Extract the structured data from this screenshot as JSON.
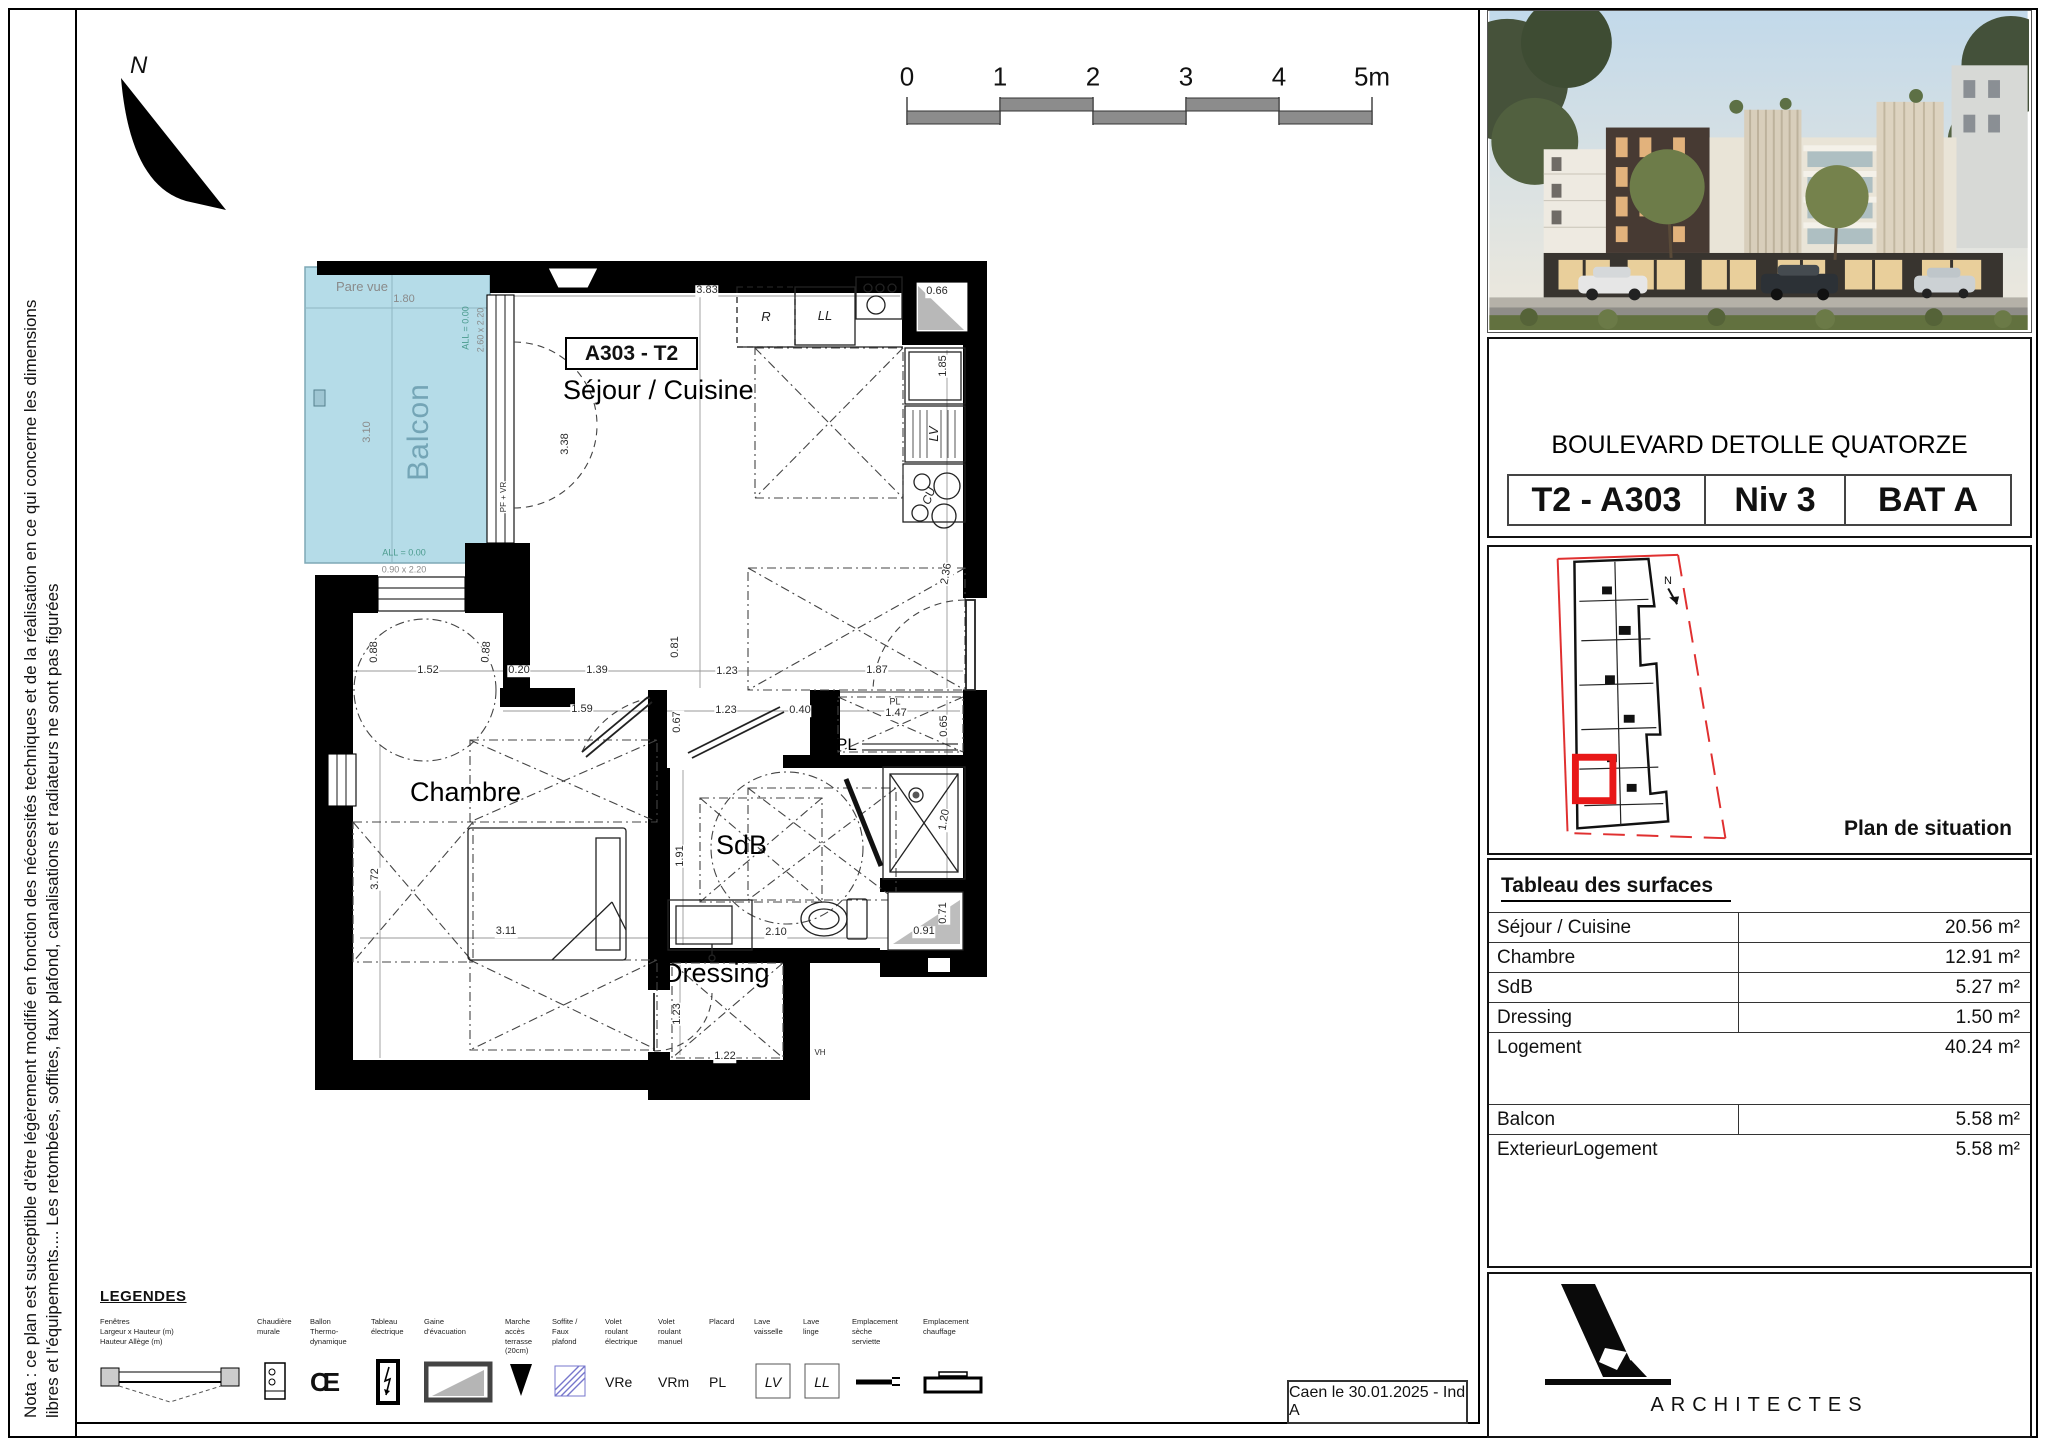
{
  "page": {
    "nota_line1": "Nota : ce plan est susceptible d'être légèrement modifié en fonction des nécessités techniques et de la réalisation en ce qui concerne les dimensions",
    "nota_line2": "libres et l'équipements.... Les retombées, soffites, faux plafond, canalisations et radiateurs ne sont pas figurées",
    "date_ref": "Caen le 30.01.2025 - Ind A",
    "north_label": "N"
  },
  "scalebar": {
    "labels": [
      "0",
      "1",
      "2",
      "3",
      "4",
      "5m"
    ]
  },
  "plan": {
    "unit_label": "A303 - T2",
    "rooms": {
      "sejour": "Séjour / Cuisine",
      "chambre": "Chambre",
      "sdb": "SdB",
      "dressing": "Dressing",
      "balcon": "Balcon",
      "placard": "PL"
    },
    "dimensions": [
      {
        "t": "Pare vue",
        "x": 362,
        "y": 287,
        "r": 0,
        "c": "g",
        "s": 13,
        "n": "pare-vue-label"
      },
      {
        "t": "1.80",
        "x": 404,
        "y": 300,
        "r": 0,
        "c": "g"
      },
      {
        "t": "3.10",
        "x": 368,
        "y": 432,
        "r": -90,
        "c": "g"
      },
      {
        "t": "ALL = 0.00",
        "x": 466,
        "y": 328,
        "r": -90,
        "c": "t",
        "s": 9
      },
      {
        "t": "2.60 x 2.20",
        "x": 481,
        "y": 330,
        "r": -90,
        "c": "g",
        "s": 9
      },
      {
        "t": "ALL = 0.00",
        "x": 404,
        "y": 553,
        "r": 0,
        "c": "t",
        "s": 9
      },
      {
        "t": "0.90 x 2.20",
        "x": 404,
        "y": 570,
        "r": 0,
        "c": "g",
        "s": 9
      },
      {
        "t": "PF + VR",
        "x": 504,
        "y": 497,
        "r": -90,
        "c": "k",
        "s": 8,
        "n": "pf-vr-label"
      },
      {
        "t": "3.83",
        "x": 707,
        "y": 291,
        "r": 0
      },
      {
        "t": "0.66",
        "x": 937,
        "y": 292,
        "r": 0
      },
      {
        "t": "1.85",
        "x": 944,
        "y": 366,
        "r": -90
      },
      {
        "t": "2.36",
        "x": 947,
        "y": 574,
        "r": -80
      },
      {
        "t": "3.38",
        "x": 566,
        "y": 444,
        "r": -90
      },
      {
        "t": "0.81",
        "x": 676,
        "y": 647,
        "r": -90
      },
      {
        "t": "1.23",
        "x": 727,
        "y": 672,
        "r": 0
      },
      {
        "t": "1.87",
        "x": 877,
        "y": 671,
        "r": 0
      },
      {
        "t": "0.88",
        "x": 375,
        "y": 652,
        "r": -90
      },
      {
        "t": "1.52",
        "x": 428,
        "y": 671,
        "r": 0
      },
      {
        "t": "0.88",
        "x": 487,
        "y": 652,
        "r": -85
      },
      {
        "t": "0.20",
        "x": 519,
        "y": 671,
        "r": 0
      },
      {
        "t": "1.39",
        "x": 597,
        "y": 671,
        "r": 0
      },
      {
        "t": "1.59",
        "x": 582,
        "y": 710,
        "r": 0
      },
      {
        "t": "0.67",
        "x": 678,
        "y": 722,
        "r": -90
      },
      {
        "t": "1.23",
        "x": 726,
        "y": 711,
        "r": 0
      },
      {
        "t": "0.40",
        "x": 800,
        "y": 711,
        "r": 0
      },
      {
        "t": "PL",
        "x": 895,
        "y": 702,
        "r": 0,
        "s": 9,
        "n": "pl-closet-dim-label"
      },
      {
        "t": "1.47",
        "x": 896,
        "y": 714,
        "r": 0
      },
      {
        "t": "0.65",
        "x": 945,
        "y": 726,
        "r": -90
      },
      {
        "t": "1.91",
        "x": 681,
        "y": 856,
        "r": -90
      },
      {
        "t": "1.20",
        "x": 945,
        "y": 820,
        "r": -80
      },
      {
        "t": "2.10",
        "x": 776,
        "y": 933,
        "r": 0
      },
      {
        "t": "0.91",
        "x": 924,
        "y": 932,
        "r": 0
      },
      {
        "t": "0.71",
        "x": 944,
        "y": 913,
        "r": -90
      },
      {
        "t": "3.72",
        "x": 376,
        "y": 879,
        "r": -90
      },
      {
        "t": "3.11",
        "x": 506,
        "y": 932,
        "r": 0
      },
      {
        "t": "1.23",
        "x": 678,
        "y": 1014,
        "r": -90
      },
      {
        "t": "1.22",
        "x": 725,
        "y": 1057,
        "r": 0
      },
      {
        "t": "VH",
        "x": 820,
        "y": 1053,
        "r": 0,
        "s": 8,
        "n": "vh-label"
      },
      {
        "t": "R",
        "x": 766,
        "y": 317,
        "r": 0,
        "s": 13,
        "a": 1,
        "n": "fridge-label"
      },
      {
        "t": "LL",
        "x": 825,
        "y": 316,
        "r": 0,
        "s": 13,
        "a": 1,
        "n": "washing-machine-label"
      },
      {
        "t": "LV",
        "x": 934,
        "y": 434,
        "r": -90,
        "s": 13,
        "a": 1,
        "n": "dishwasher-label"
      },
      {
        "t": "CU",
        "x": 929,
        "y": 496,
        "r": -70,
        "s": 12,
        "a": 1,
        "n": "cooktop-label"
      }
    ]
  },
  "panel": {
    "project_title": "BOULEVARD DETOLLE QUATORZE",
    "unit": "T2 - A303",
    "level": "Niv 3",
    "building": "BAT A",
    "situation_label": "Plan de situation",
    "situation_north": "N",
    "surfaces": {
      "title": "Tableau des surfaces",
      "rows": [
        {
          "label": "Séjour / Cuisine",
          "value": "20.56 m²"
        },
        {
          "label": "Chambre",
          "value": "12.91 m²"
        },
        {
          "label": "SdB",
          "value": "5.27 m²"
        },
        {
          "label": "Dressing",
          "value": "1.50 m²"
        },
        {
          "label": "Logement",
          "value": "40.24 m²"
        }
      ],
      "rows2": [
        {
          "label": "Balcon",
          "value": "5.58 m²"
        },
        {
          "label": "ExterieurLogement",
          "value": "5.58 m²"
        }
      ]
    },
    "architect": "ARCHITECTES"
  },
  "legend": {
    "title": "LEGENDES",
    "symbols": {
      "ce": "CE",
      "vre": "VRe",
      "vrm": "VRm",
      "pl": "PL",
      "lv": "LV",
      "ll": "LL"
    },
    "items": [
      {
        "label": "Fenêtres\nLargeur x Hauteur (m)\nHauteur Allège (m)"
      },
      {
        "label": "Chaudière\nmurale"
      },
      {
        "label": "Ballon\nThermo-\ndynamique"
      },
      {
        "label": "Tableau\nélectrique"
      },
      {
        "label": "Gaine\nd'évacuation"
      },
      {
        "label": "Marche\naccès\nterrasse\n(20cm)"
      },
      {
        "label": "Soffite /\nFaux\nplafond"
      },
      {
        "label": "Volet\nroulant\nélectrique"
      },
      {
        "label": "Volet\nroulant\nmanuel"
      },
      {
        "label": "Placard"
      },
      {
        "label": "Lave\nvaisselle"
      },
      {
        "label": "Lave\nlinge"
      },
      {
        "label": "Emplacement\nsèche\nserviette"
      },
      {
        "label": "Emplacement\nchauffage"
      }
    ]
  }
}
